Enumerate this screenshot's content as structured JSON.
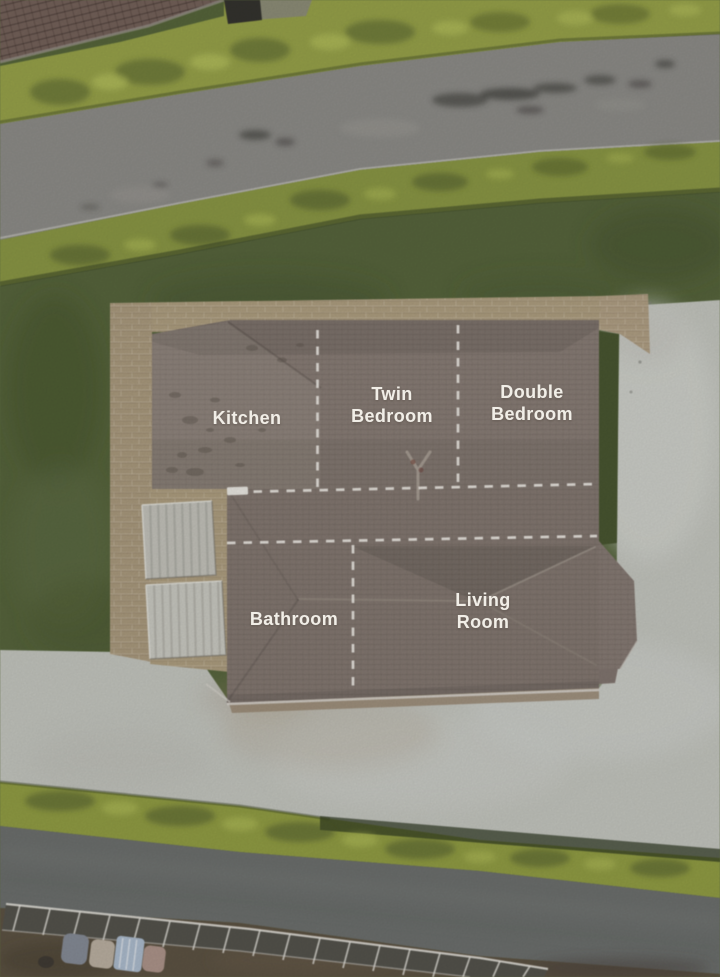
{
  "scene": {
    "kind": "aerial-property-photo-with-room-overlay",
    "colors": {
      "roof": "#8c7f77",
      "grass": "#57663b",
      "hedge": "#99a545",
      "upper_road": "#8f8e8a",
      "lower_road": "#6e716f",
      "driveway": "#c6c8c1",
      "stone_path": "#b1a07f",
      "shed": "#c9c8c0",
      "neighbor_roof": "#77635a",
      "overlay_line": "#f0ede7",
      "overlay_text": "#f1eee7"
    }
  },
  "annotation_overlay": {
    "rooms": [
      {
        "label": "Kitchen"
      },
      {
        "label": "Twin Bedroom"
      },
      {
        "label": "Double Bedroom"
      },
      {
        "label": "Bathroom"
      },
      {
        "label": "Living Room"
      }
    ]
  }
}
